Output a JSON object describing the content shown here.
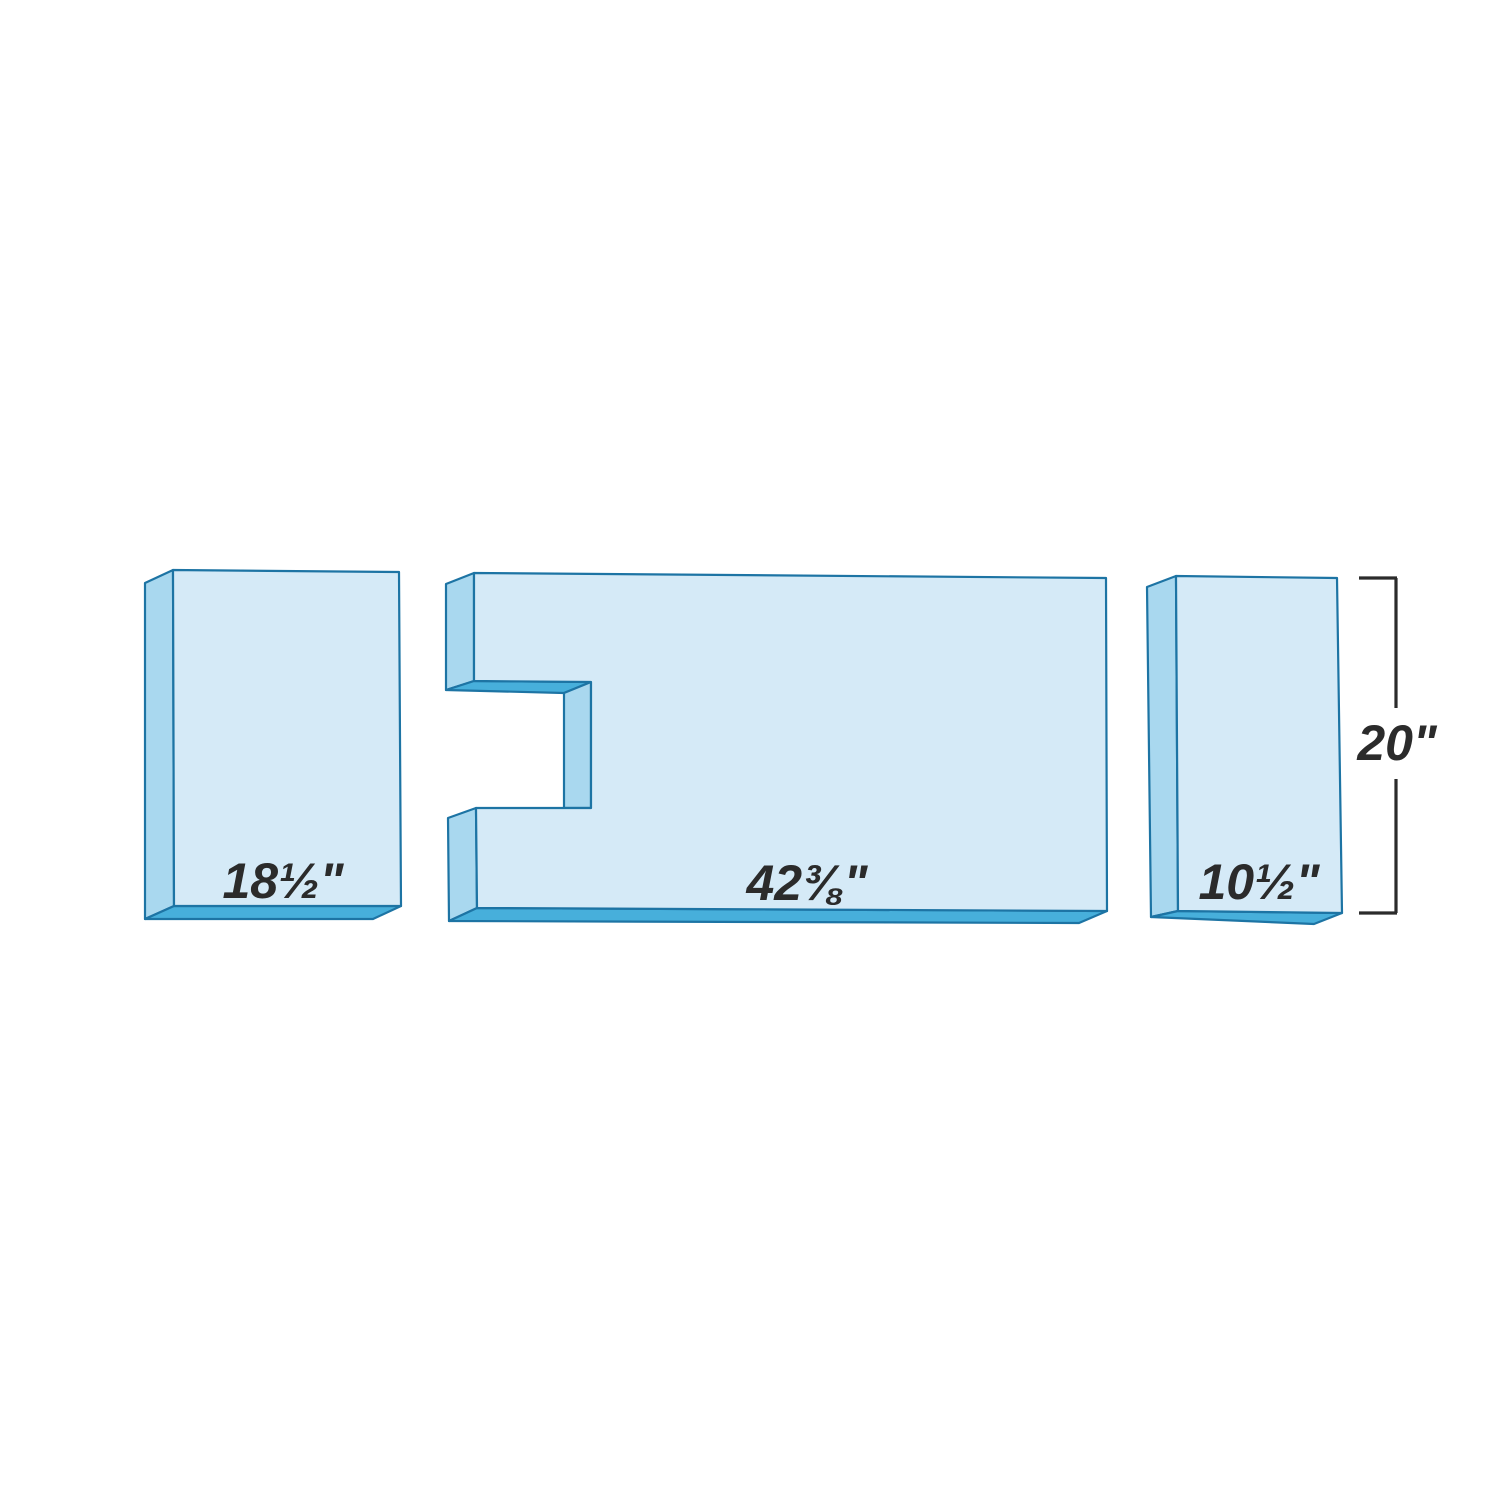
{
  "diagram": {
    "title": "three-piece panel cutting diagram",
    "background_color": "#ffffff",
    "colors": {
      "front_face": "#d5eaf7",
      "side_face": "#a9d8ef",
      "bottom_face": "#47afdb",
      "outline": "#1d74a4",
      "text": "#2b2b2b",
      "dimension_line": "#2b2b2b"
    },
    "pieces": [
      {
        "id": "left-panel",
        "width_label": "18½\""
      },
      {
        "id": "center-panel-notched",
        "width_label": "42⅜\""
      },
      {
        "id": "right-panel",
        "width_label": "10½\""
      }
    ],
    "dimension": {
      "height_label": "20\""
    }
  }
}
